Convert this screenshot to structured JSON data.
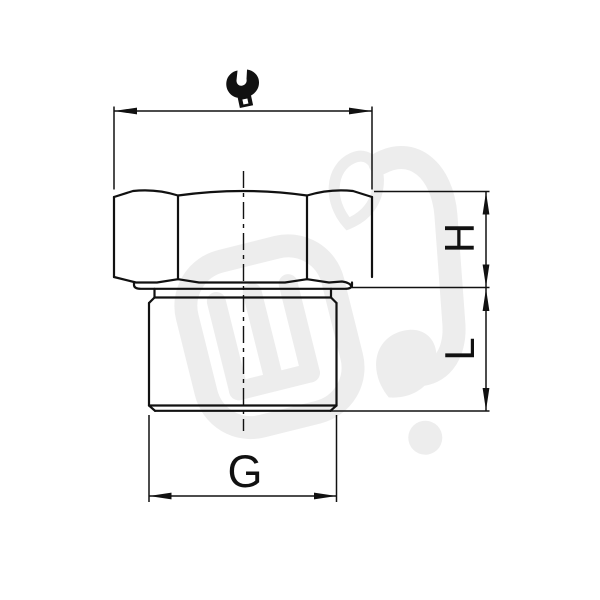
{
  "drawing": {
    "kind": "technical dimension drawing",
    "labels": {
      "hex_height": "H",
      "thread_length": "L",
      "thread_size": "G"
    },
    "icons": {
      "spanner": "wrench-icon"
    },
    "colors": {
      "line": "#111111",
      "watermark": "#ededed",
      "background": "#ffffff"
    }
  }
}
